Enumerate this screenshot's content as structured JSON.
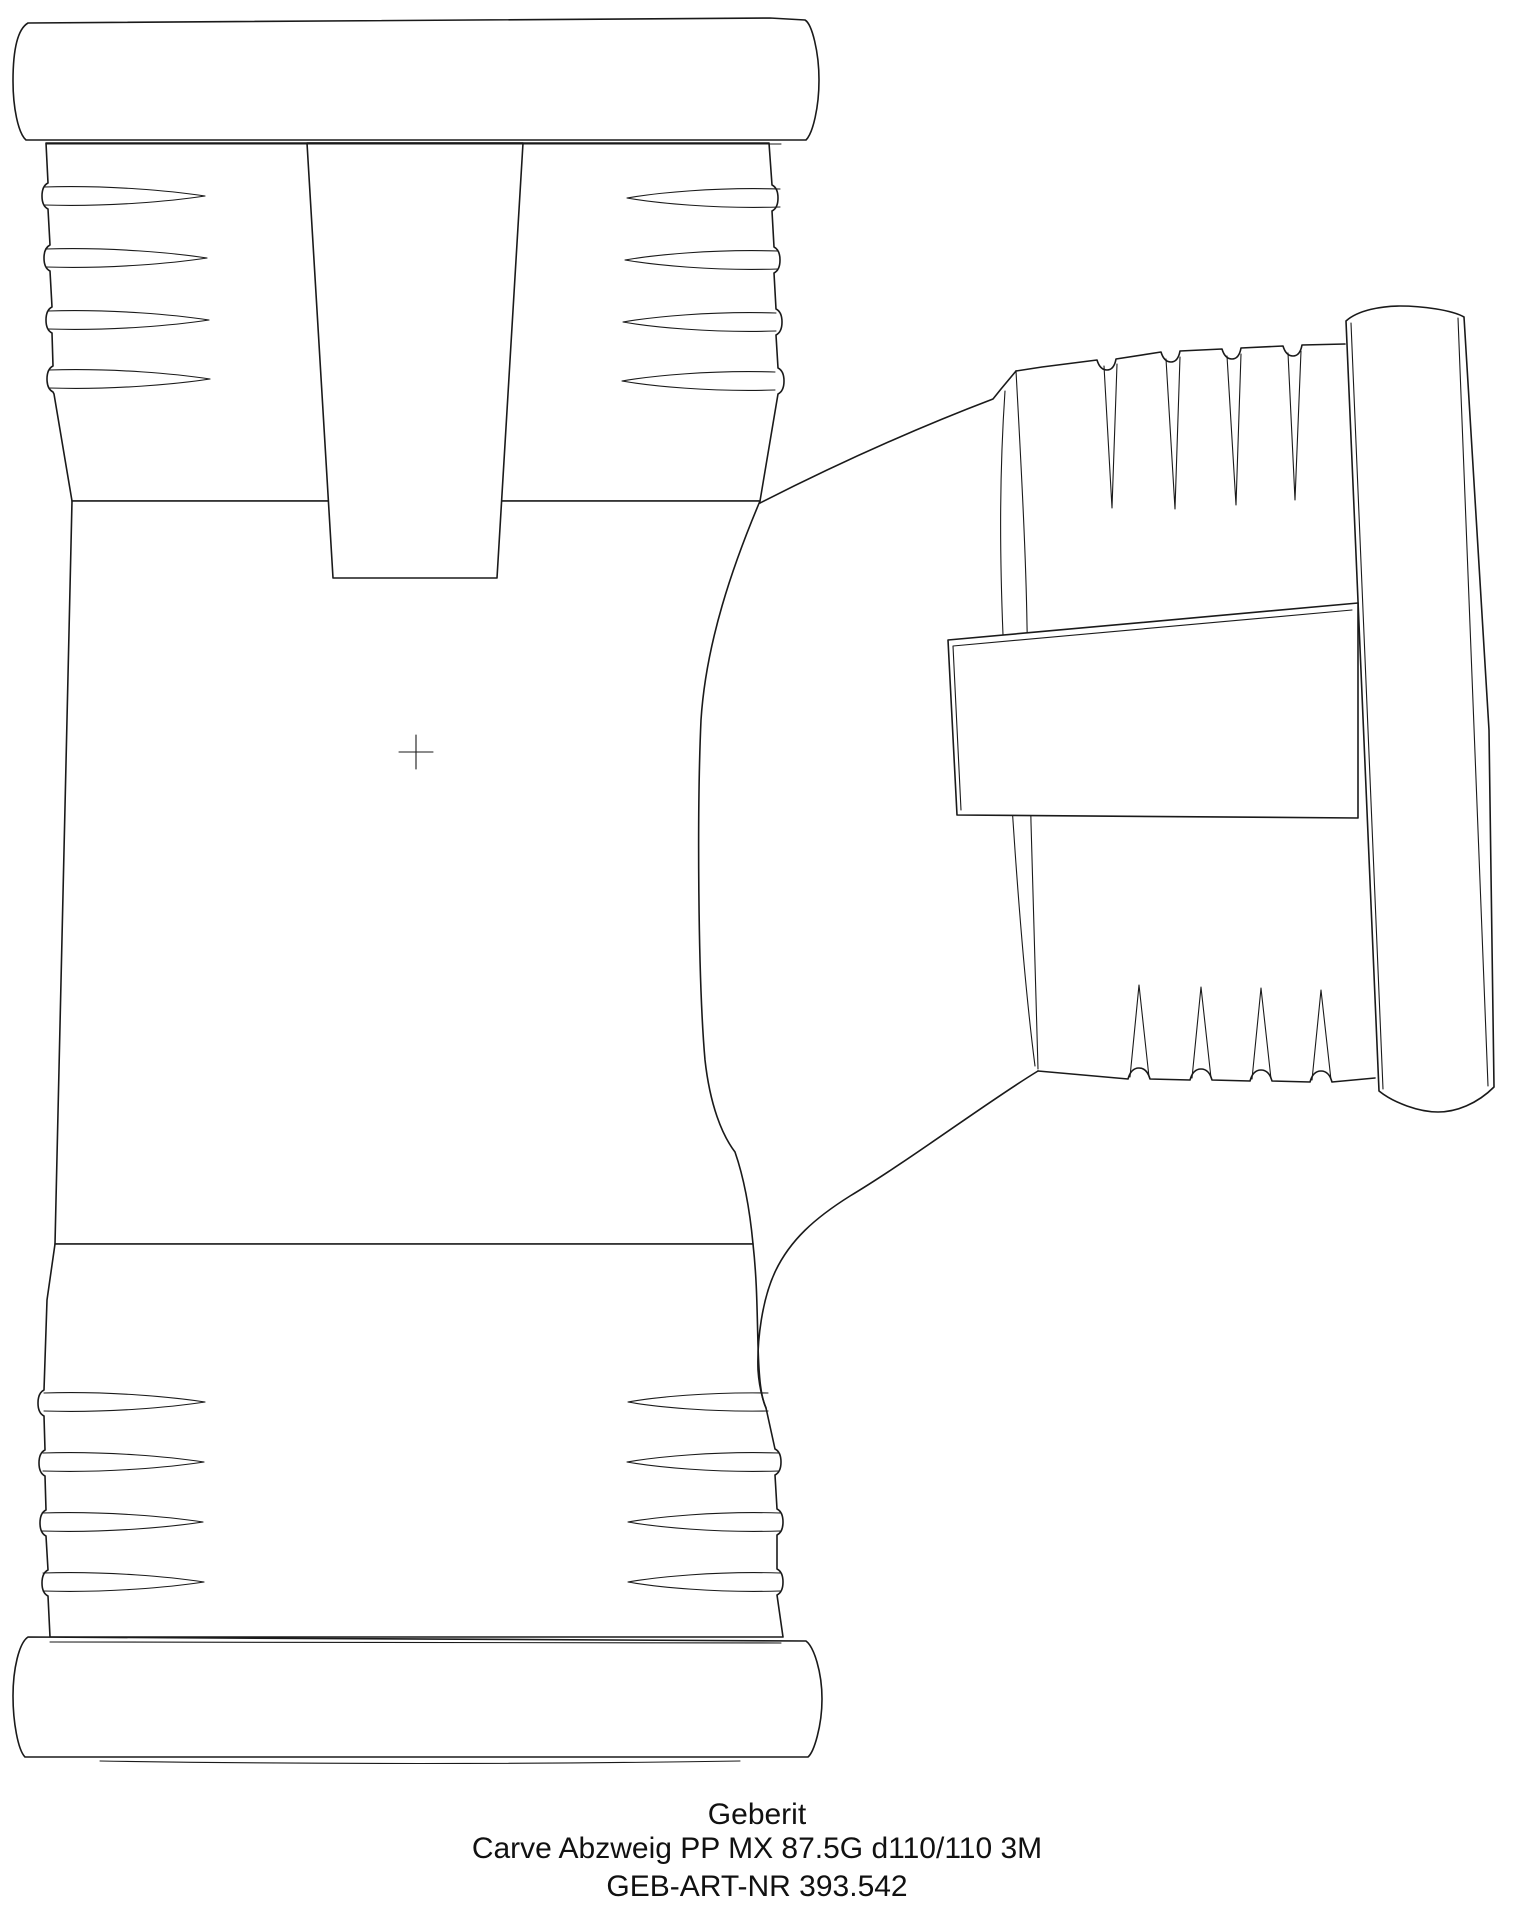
{
  "drawing": {
    "type": "technical-line-drawing",
    "subject": "pipe branch fitting, 87.5 degree swept tee with push-fit sockets",
    "background_color": "#ffffff",
    "line_color": "#1a1a1a",
    "text_color": "#111111",
    "center_mark": "+"
  },
  "caption": {
    "brand": "Geberit",
    "description": "Carve Abzweig PP MX 87.5G d110/110 3M",
    "article_number": "GEB-ART-NR 393.542"
  }
}
